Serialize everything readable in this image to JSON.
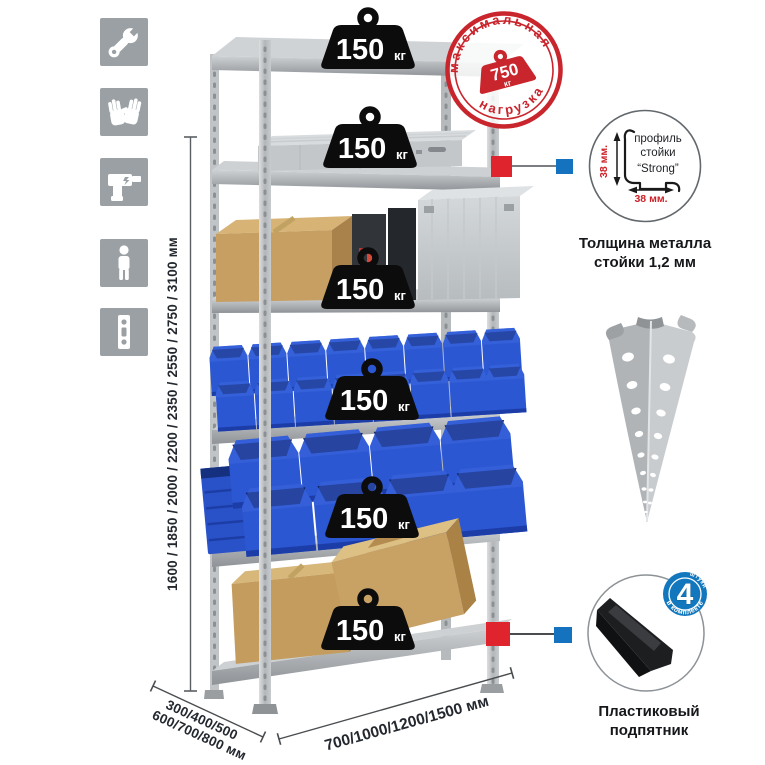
{
  "icons": {
    "items": [
      {
        "name": "wrench"
      },
      {
        "name": "gloves"
      },
      {
        "name": "drill"
      },
      {
        "name": "person"
      },
      {
        "name": "perforated-profile"
      }
    ]
  },
  "rack": {
    "shelf_count": 6,
    "shelves": [
      {
        "load": "150",
        "unit": "кг"
      },
      {
        "load": "150",
        "unit": "кг"
      },
      {
        "load": "150",
        "unit": "кг"
      },
      {
        "load": "150",
        "unit": "кг"
      },
      {
        "load": "150",
        "unit": "кг"
      },
      {
        "load": "150",
        "unit": "кг"
      }
    ]
  },
  "stamp": {
    "arc_top": "максимальная",
    "arc_bottom": "нагрузка",
    "value": "750",
    "unit": "кг"
  },
  "dimensions": {
    "height": "1600 / 1850 / 2000 / 2200 / 2350 / 2550 / 2750 / 3100 мм",
    "width": "700/1000/1200/1500 мм",
    "depth1": "300/400/500",
    "depth2": "600/700/800 мм"
  },
  "profile_detail": {
    "line1": "профиль",
    "line2": "стойки",
    "line3": "“Strong”",
    "dim_vertical": "38 мм.",
    "dim_horizontal": "38 мм.",
    "caption1": "Толщина металла",
    "caption2": "стойки 1,2 мм"
  },
  "foot_detail": {
    "badge_value": "4",
    "badge_top": "штуки",
    "badge_bottom": "в комплекте",
    "caption1": "Пластиковый",
    "caption2": "подпятник"
  },
  "colors": {
    "stamp_red": "#c9252c",
    "marker_red": "#e0242e",
    "marker_blue": "#1472bf",
    "badge_blue": "#1277bd",
    "icon_gray": "#9aa0a4",
    "bin_blue": "#2c57d2",
    "metal_light": "#d5d8da",
    "metal_mid": "#b9bdc0",
    "cardboard": "#c69e60"
  }
}
